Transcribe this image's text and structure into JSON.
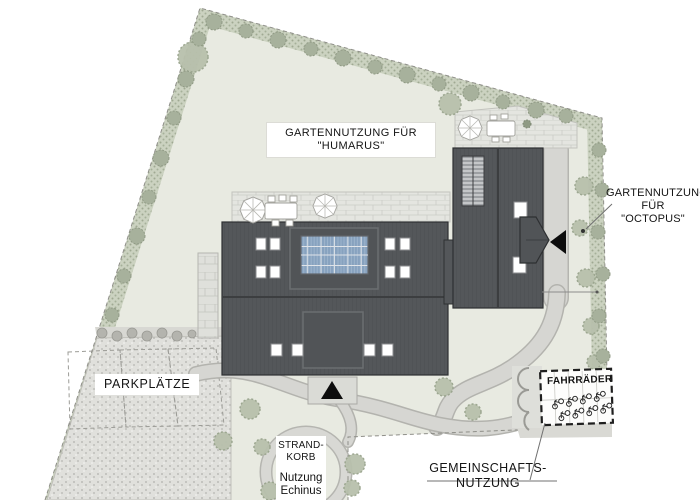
{
  "labels": {
    "garden_humarus": {
      "line1": "GARTENNUTZUNG FÜR",
      "line2": "\"HUMARUS\""
    },
    "garden_octopus": {
      "line1": "GARTENNUTZUNG",
      "line2": "FÜR",
      "line3": "\"OCTOPUS\""
    },
    "parking": "PARKPLÄTZE",
    "beach_chair": {
      "line1": "STRAND-",
      "line2": "KORB",
      "line3": "Nutzung",
      "line4": "Echinus"
    },
    "bike_shed": "FAHRRÄDER",
    "community": {
      "line1": "GEMEINSCHAFTS-",
      "line2": "NUTZUNG"
    }
  },
  "colors": {
    "site_green": "#e8eae1",
    "hedge_green": "#cbd2c0",
    "roof_dark": "#54575a",
    "solar_blue": "#87a2bf",
    "path_gray": "#d6d6d2",
    "gravel_gray": "#e0e0dc",
    "paving_gray": "#e4e5e0",
    "arrow_black": "#0d0d0d"
  },
  "icons": {
    "entrance_arrow_main": "black triangle pointing up at main building entrance",
    "entrance_arrow_octopus": "black triangle pointing left at side building entrance",
    "parasol": "white parasol seen from above",
    "table_with_chairs": "white garden table with chairs",
    "bicycle": "small bicycle symbol in bike shed",
    "tree": "round canopy symbol",
    "solar_panels": "blue photovoltaic array on roof"
  }
}
